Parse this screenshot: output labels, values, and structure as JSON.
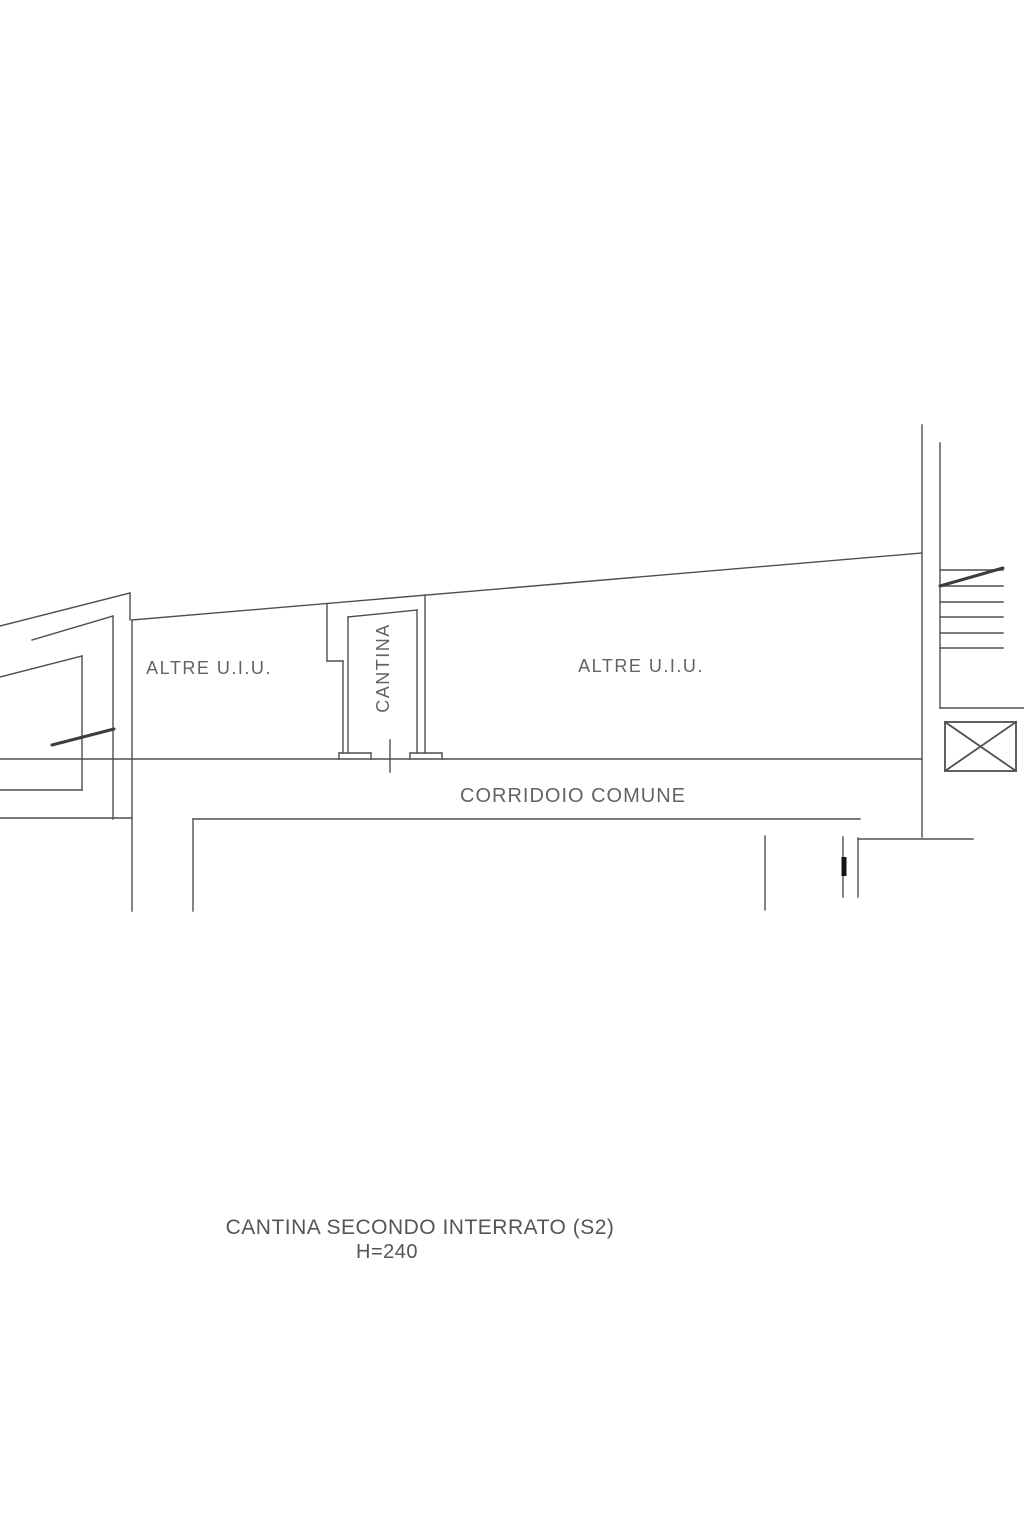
{
  "plan": {
    "labels": {
      "altre_uiu_left": "ALTRE U.I.U.",
      "cantina_room": "CANTINA",
      "altre_uiu_right": "ALTRE U.I.U.",
      "corridoio": "CORRIDOIO COMUNE"
    },
    "caption": {
      "line1": "CANTINA SECONDO INTERRATO (S2)",
      "line2": "H=240"
    },
    "colors": {
      "line": "#4f4f4f",
      "thick_line": "#3d3d3d",
      "door_mark": "#141414",
      "label_text": "#636363",
      "caption_text": "#555555",
      "background": "#ffffff"
    }
  }
}
